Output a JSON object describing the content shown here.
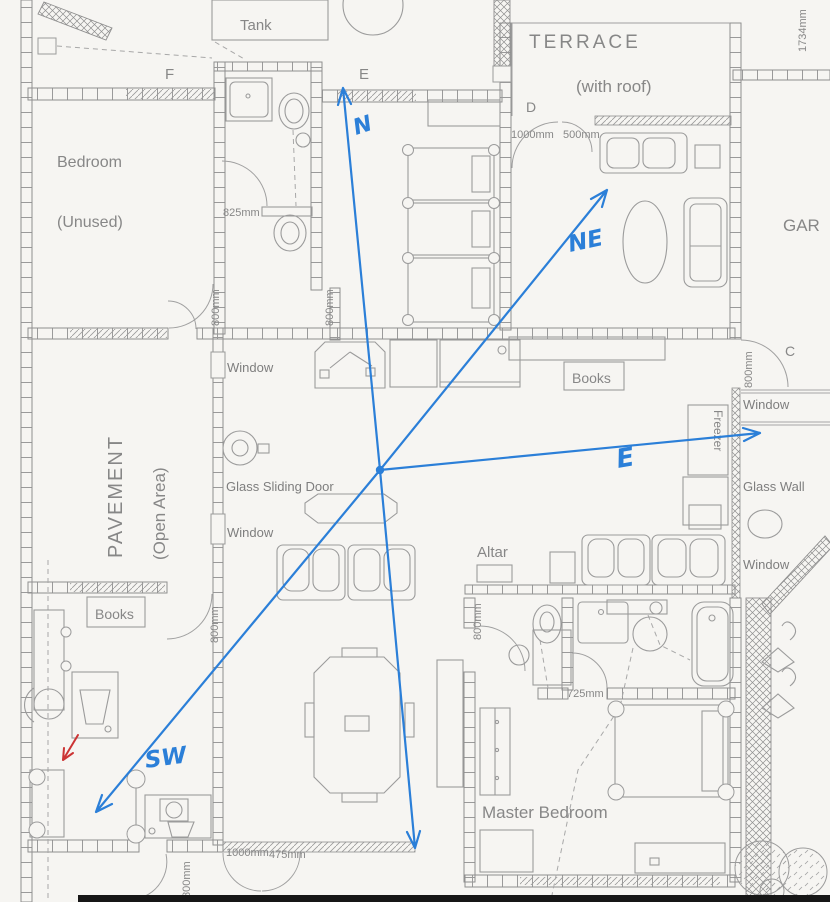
{
  "plan": {
    "rooms": {
      "bedroom": "Bedroom",
      "bedroom_status": "(Unused)",
      "terrace": "TERRACE",
      "terrace_note": "(with roof)",
      "pavement": "PAVEMENT",
      "pavement_note": "(Open Area)",
      "master_bedroom": "Master Bedroom",
      "garden_partial": "GAR",
      "tank": "Tank",
      "altar": "Altar",
      "books": "Books",
      "freezer": "Freezer"
    },
    "features": {
      "window": "Window",
      "glass_sliding_door": "Glass Sliding Door",
      "glass_wall": "Glass Wall"
    },
    "grid": {
      "f": "F",
      "e": "E",
      "d": "D",
      "c": "C"
    },
    "dimensions": {
      "d825": "825mm",
      "d800": "800mm",
      "d1000": "1000mm",
      "d500": "500mm",
      "d1734": "1734mm",
      "d725": "725mm",
      "d475": "475mm"
    },
    "compass": {
      "north": "N",
      "northeast": "NE",
      "east": "E",
      "southwest": "SW"
    },
    "colors": {
      "ink_blue": "#2b7fd8",
      "ink_red": "#cc3434",
      "line_gray": "#8f8f8f",
      "text_gray": "#878787",
      "paper": "#f6f5f2"
    }
  }
}
